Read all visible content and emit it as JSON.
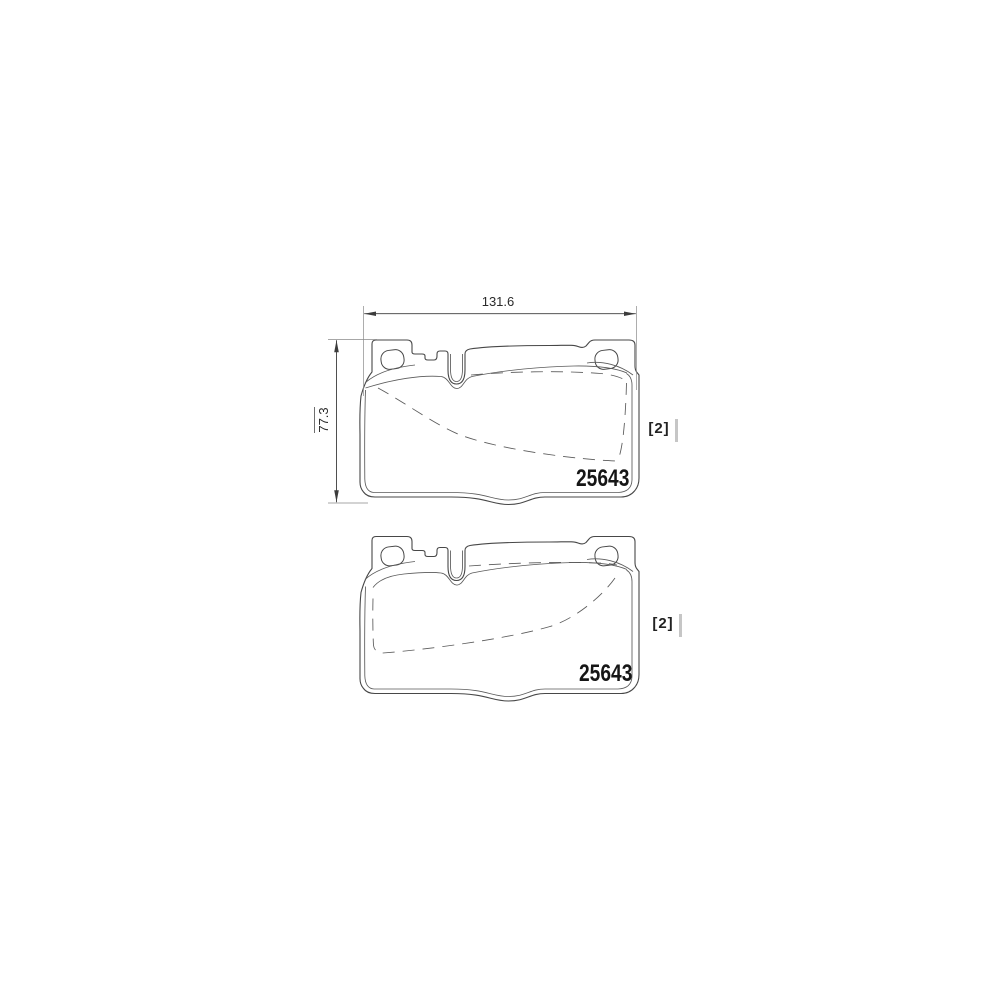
{
  "diagram": {
    "width_dimension": "131.6",
    "height_dimension": "77.3",
    "pads": [
      {
        "part_number": "25643",
        "quantity": "[2]"
      },
      {
        "part_number": "25643",
        "quantity": "[2]"
      }
    ],
    "colors": {
      "outline": "#474747",
      "inner_line": "#5a5a5a",
      "dimension": "#3c3c3c",
      "extension": "#8a8a8a",
      "text": "#1d1d1d",
      "artifact_bar": "#c6c6c6",
      "background": "#ffffff"
    }
  }
}
